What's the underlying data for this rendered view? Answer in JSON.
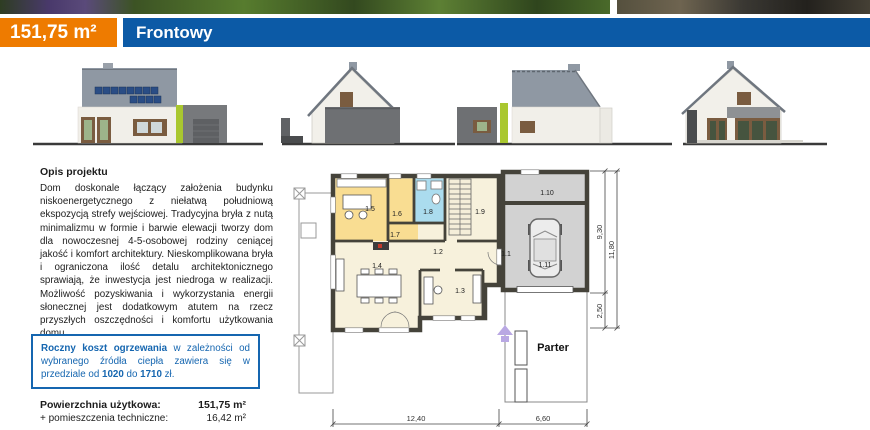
{
  "header": {
    "area_badge": "151,75 m²",
    "project_name": "Frontowy"
  },
  "description": {
    "heading": "Opis projektu",
    "body": "Dom doskonale łączący założenia budynku niskoenergetycznego z niełatwą południową ekspozycją strefy wejściowej. Tradycyjna bryła z nutą minimalizmu w formie i barwie elewacji tworzy dom dla nowoczesnej 4-5-osobowej rodziny ceniącej jakość i komfort architektury. Nieskomplikowana bryła i ograniczona ilość detalu architektonicznego sprawiają, że inwestycja jest niedroga w realizacji. Możliwość pozyskiwania i wykorzystania energii słonecznej jest dodatkowym atutem na rzecz przyszłych oszczędności i komfortu użytkowania domu."
  },
  "heating_box": {
    "intro_bold": "Roczny koszt ogrzewania",
    "middle": " w zależności od wybranego źródła ciepła zawiera się w przedziale od ",
    "low": "1020",
    "between": " do ",
    "high": "1710",
    "suffix": " zł."
  },
  "areas": {
    "rows": [
      {
        "label": "Powierzchnia użytkowa:",
        "value": "151,75 m²"
      },
      {
        "label": "+ pomieszczenia techniczne:",
        "value": "16,42 m²"
      }
    ]
  },
  "plan": {
    "floor_label": "Parter",
    "rooms": {
      "r1": "1.1",
      "r2": "1.2",
      "r3": "1.3",
      "r4": "1.4",
      "r5": "1.5",
      "r6": "1.6",
      "r7": "1.7",
      "r8": "1.8",
      "r9": "1.9",
      "r10": "1.10",
      "r11": "1.11"
    },
    "dims": {
      "width_house": "12,40",
      "width_garage": "6,60",
      "width_total": "19,00",
      "depth_main": "9,30",
      "depth_porch": "2,50",
      "depth_total": "11,80"
    }
  },
  "colors": {
    "accent_orange": "#ee7b00",
    "header_blue": "#0c5aa6",
    "info_blue": "#1566b0",
    "lime_accent": "#a9c72f",
    "room_yellow": "#f9dd92",
    "room_blue": "#abdcee",
    "room_cream": "#f7f1dc",
    "garage_grey": "#d2d2d2",
    "plan_wall": "#45433a"
  }
}
